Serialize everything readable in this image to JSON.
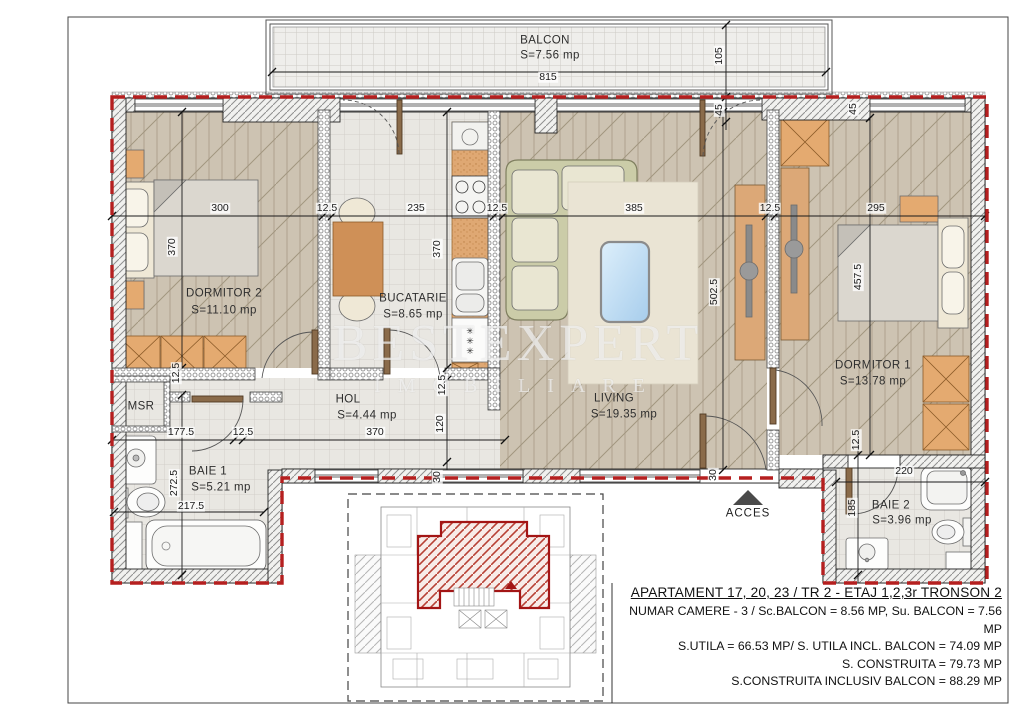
{
  "watermark": {
    "line1": "BESTEXPERT",
    "line2": "IMOBILIARE"
  },
  "balcony": {
    "name": "BALCON",
    "area": "S=7.56 mp",
    "width": "815",
    "depth": "105",
    "wall": "45"
  },
  "rooms": {
    "dormitor2": {
      "name": "DORMITOR 2",
      "area": "S=11.10 mp"
    },
    "bucatarie": {
      "name": "BUCATARIE",
      "area": "S=8.65 mp"
    },
    "hol": {
      "name": "HOL",
      "area": "S=4.44 mp"
    },
    "living": {
      "name": "LIVING",
      "area": "S=19.35 mp"
    },
    "dormitor1": {
      "name": "DORMITOR 1",
      "area": "S=13.78 mp"
    },
    "baie1": {
      "name": "BAIE 1",
      "area": "S=5.21 mp"
    },
    "baie2": {
      "name": "BAIE 2",
      "area": "S=3.96 mp"
    },
    "msr": {
      "name": "MSR"
    }
  },
  "dims": {
    "main_row": [
      "300",
      "12.5",
      "235",
      "12.5",
      "385",
      "12.5",
      "295"
    ],
    "dorm2_depth": "370",
    "kitchen_depth": "370",
    "living_depth": "502.5",
    "dorm1_depth": "457.5",
    "wall45_a": "45",
    "wall45_b": "45",
    "baie1_a": "177.5",
    "baie1_wall": "12.5",
    "hol_width": "370",
    "baie1_width": "217.5",
    "baie1_depth": "272.5",
    "hall_depth": "120",
    "wall30_a": "30",
    "wall30_b": "30",
    "dorm2_wall": "12.5",
    "kitchen_wall": "12.5",
    "baie2_width": "220",
    "baie2_depth": "185",
    "baie2_wall": "12.5"
  },
  "access": "ACCES",
  "title_block": {
    "line1": "APARTAMENT 17, 20, 23 / TR 2 - ETAJ 1,2,3r TRONSON 2",
    "line2": "NUMAR CAMERE - 3 / Sc.BALCON = 8.56 MP, Su. BALCON = 7.56 MP",
    "line3": "S.UTILA = 66.53 MP/ S. UTILA INCL. BALCON = 74.09 MP",
    "line4": "S. CONSTRUITA = 79.73 MP",
    "line5": "S.CONSTRUITA INCLUSIV BALCON = 88.29 MP"
  }
}
